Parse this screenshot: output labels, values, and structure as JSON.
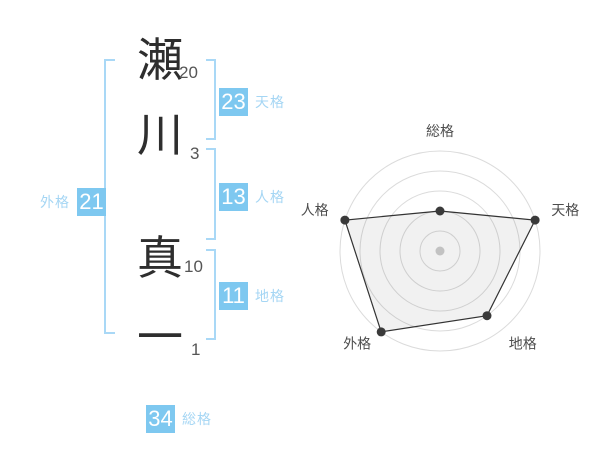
{
  "colors": {
    "badge_bg": "#7EC8F0",
    "badge_text": "#FFFFFF",
    "badge_label": "#A5D6F4",
    "bracket": "#A9D8F6",
    "kanji_text": "#2e2e2e",
    "stroke_num_text": "#555555",
    "chart_ring": "#DBDBDB",
    "chart_line": "#333333",
    "chart_point": "#3a3a3a",
    "chart_center_dot": "#c2c2c2",
    "chart_fill": "rgba(0,0,0,0.055)",
    "chart_label": "#4d4d4d"
  },
  "name_panel": {
    "characters": [
      {
        "char": "瀬",
        "strokes": "20"
      },
      {
        "char": "川",
        "strokes": "3"
      },
      {
        "char": "真",
        "strokes": "10"
      },
      {
        "char": "一",
        "strokes": "1"
      }
    ],
    "gaikaku": {
      "value": "21",
      "label": "外格"
    },
    "tenkaku": {
      "value": "23",
      "label": "天格"
    },
    "jinkaku": {
      "value": "13",
      "label": "人格"
    },
    "chikaku": {
      "value": "11",
      "label": "地格"
    },
    "soukaku": {
      "value": "34",
      "label": "総格"
    }
  },
  "chart_data": {
    "type": "radar",
    "categories": [
      "総格",
      "天格",
      "地格",
      "外格",
      "人格"
    ],
    "values": [
      40,
      100,
      80,
      100,
      100
    ],
    "max": 100,
    "rings": 5,
    "ring_step": 20,
    "angles_deg": [
      90,
      18,
      -54,
      -126,
      162
    ],
    "grid": "concentric-circles",
    "legend": false,
    "title": ""
  }
}
